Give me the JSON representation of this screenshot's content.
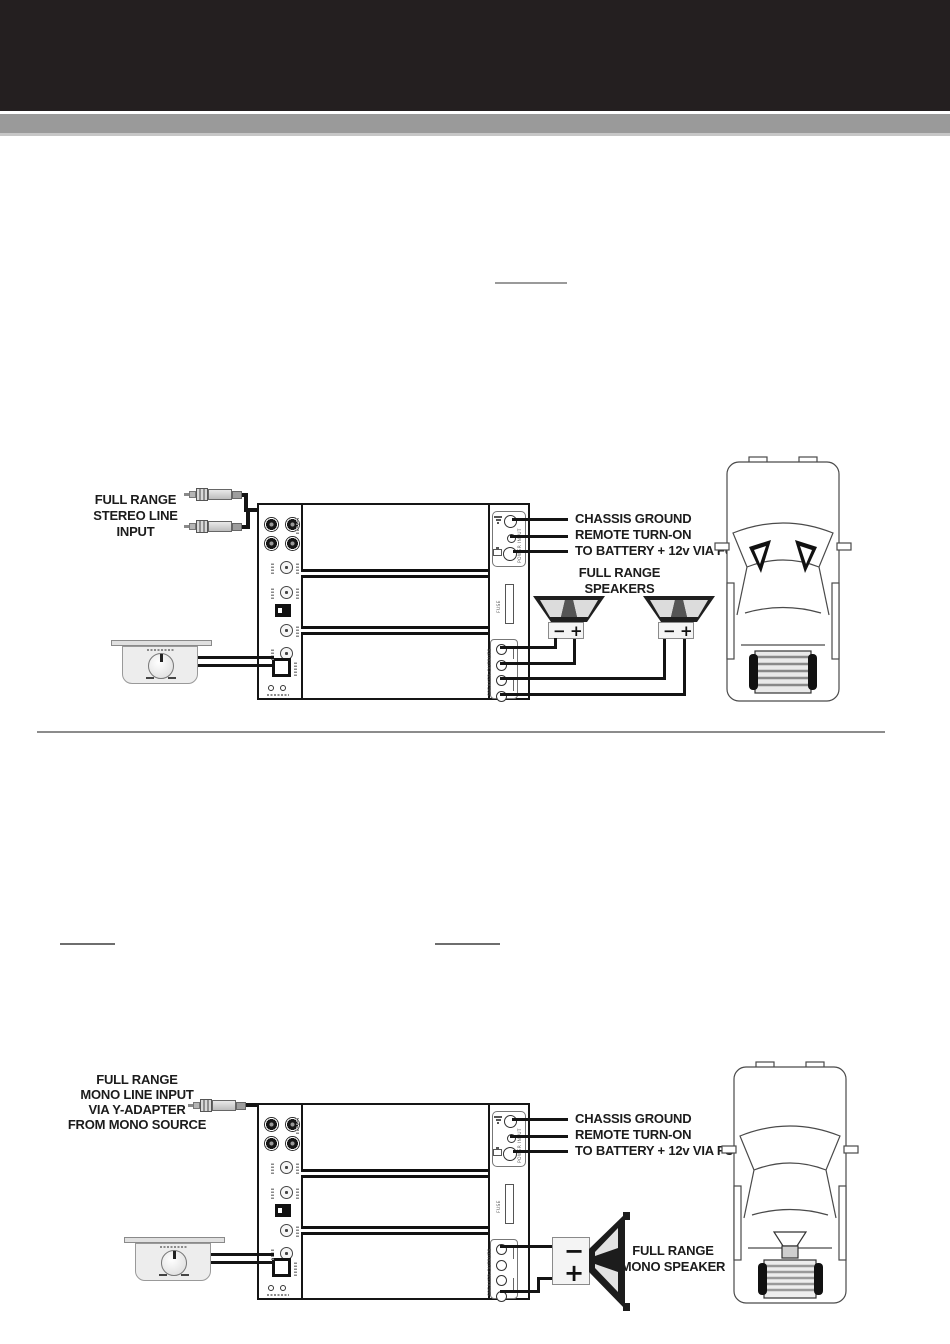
{
  "colors": {
    "header_bg": "#241f20",
    "band_gray": "#9a9a9a",
    "line_art": "#1a1a1a"
  },
  "amp": {
    "fuse_label": "FUSE",
    "power_input_label": "POWER INPUT",
    "speaker_outputs_label": "SPEAKER OUTPUTS"
  },
  "diagram1": {
    "source_label_lines": [
      "FULL RANGE",
      "STEREO LINE",
      "INPUT"
    ],
    "connection_labels": [
      "CHASSIS GROUND",
      "REMOTE TURN-ON",
      "TO BATTERY + 12v VIA FUSE"
    ],
    "speakers_label_lines": [
      "FULL RANGE",
      "SPEAKERS"
    ],
    "left_speaker": {
      "minus": "−",
      "plus": "+"
    },
    "right_speaker": {
      "minus": "−",
      "plus": "+"
    }
  },
  "diagram2": {
    "source_label_lines": [
      "FULL RANGE",
      "MONO LINE INPUT",
      "VIA Y-ADAPTER",
      "FROM MONO SOURCE"
    ],
    "connection_labels": [
      "CHASSIS GROUND",
      "REMOTE TURN-ON",
      "TO BATTERY + 12v VIA FUSE"
    ],
    "speaker_label_lines": [
      "FULL RANGE",
      "MONO SPEAKER"
    ],
    "mono_speaker": {
      "minus": "−",
      "plus": "+"
    }
  }
}
